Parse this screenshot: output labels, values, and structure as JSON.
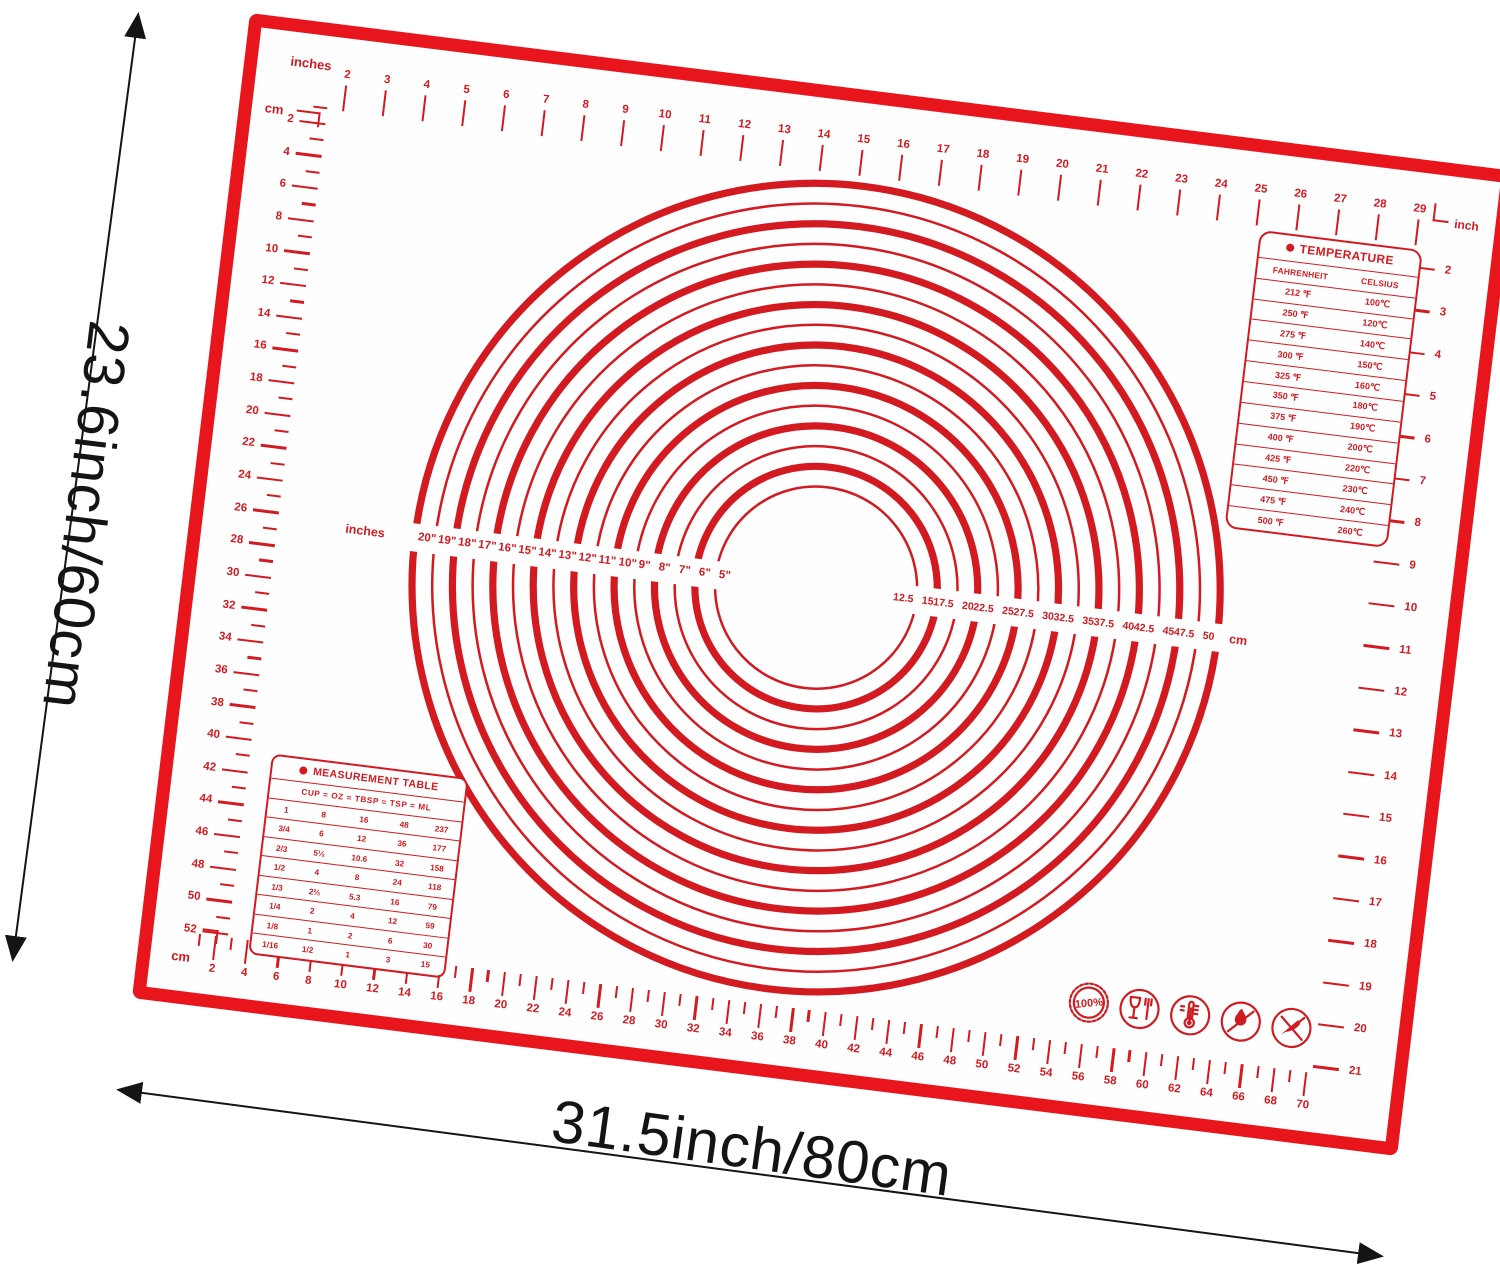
{
  "annotations": {
    "height_label": "23.6inch/60cm",
    "width_label": "31.5inch/80cm"
  },
  "colors": {
    "mat_frame_red": "#e8151d",
    "print_red": "#d31a21",
    "annotation_black": "#141414",
    "background": "#ffffff"
  },
  "rulers": {
    "top": {
      "unit_label": "inches",
      "numbers": [
        2,
        3,
        4,
        5,
        6,
        7,
        8,
        9,
        10,
        11,
        12,
        13,
        14,
        15,
        16,
        17,
        18,
        19,
        20,
        21,
        22,
        23,
        24,
        25,
        26,
        27,
        28,
        29
      ]
    },
    "right": {
      "unit_label": "inch",
      "numbers": [
        2,
        3,
        4,
        5,
        6,
        7,
        8,
        9,
        10,
        11,
        12,
        13,
        14,
        15,
        16,
        17,
        18,
        19,
        20,
        21
      ]
    },
    "left": {
      "unit_label": "cm",
      "numbers": [
        2,
        4,
        6,
        8,
        10,
        12,
        14,
        16,
        18,
        20,
        22,
        24,
        26,
        28,
        30,
        32,
        34,
        36,
        38,
        40,
        42,
        44,
        46,
        48,
        50,
        52
      ]
    },
    "bottom": {
      "unit_label": "cm",
      "numbers": [
        2,
        4,
        6,
        8,
        10,
        12,
        14,
        16,
        18,
        20,
        22,
        24,
        26,
        28,
        30,
        32,
        34,
        36,
        38,
        40,
        42,
        44,
        46,
        48,
        50,
        52,
        54,
        56,
        58,
        60,
        62,
        64,
        66,
        68,
        70
      ]
    }
  },
  "rolling_guide": {
    "inch_axis_label": "inches",
    "cm_axis_label": "cm",
    "diameters_inches": [
      5,
      6,
      7,
      8,
      9,
      10,
      11,
      12,
      13,
      14,
      15,
      16,
      17,
      18,
      19,
      20
    ],
    "inch_labels": [
      "20\"",
      "19\"",
      "18\"",
      "17\"",
      "16\"",
      "15\"",
      "14\"",
      "13\"",
      "12\"",
      "11\"",
      "10\"",
      "9\"",
      "8\"",
      "7\"",
      "6\"",
      "5\""
    ],
    "cm_labels": [
      "12.5",
      "15",
      "17.5",
      "20",
      "22.5",
      "25",
      "27.5",
      "30",
      "32.5",
      "35",
      "37.5",
      "40",
      "42.5",
      "45",
      "47.5",
      "50"
    ]
  },
  "temperature_table": {
    "title": "TEMPERATURE",
    "columns": [
      "FAHRENHEIT",
      "CELSIUS"
    ],
    "rows": [
      [
        "212 ℉",
        "100℃"
      ],
      [
        "250 ℉",
        "120℃"
      ],
      [
        "275 ℉",
        "140℃"
      ],
      [
        "300 ℉",
        "150℃"
      ],
      [
        "325 ℉",
        "160℃"
      ],
      [
        "350 ℉",
        "180℃"
      ],
      [
        "375 ℉",
        "190℃"
      ],
      [
        "400 ℉",
        "200℃"
      ],
      [
        "425 ℉",
        "220℃"
      ],
      [
        "450 ℉",
        "230℃"
      ],
      [
        "475 ℉",
        "240℃"
      ],
      [
        "500 ℉",
        "260℃"
      ]
    ]
  },
  "measurement_table": {
    "title": "MEASUREMENT TABLE",
    "header": "CUP  =  OZ  =  TBSP  =  TSP  =  ML",
    "rows": [
      [
        "1",
        "8",
        "16",
        "48",
        "237"
      ],
      [
        "3/4",
        "6",
        "12",
        "36",
        "177"
      ],
      [
        "2/3",
        "5⅓",
        "10.6",
        "32",
        "158"
      ],
      [
        "1/2",
        "4",
        "8",
        "24",
        "118"
      ],
      [
        "1/3",
        "2⅔",
        "5.3",
        "16",
        "79"
      ],
      [
        "1/4",
        "2",
        "4",
        "12",
        "59"
      ],
      [
        "1/8",
        "1",
        "2",
        "6",
        "30"
      ],
      [
        "1/16",
        "1/2",
        "1",
        "3",
        "15"
      ]
    ]
  },
  "icons": {
    "badge_text": "100%"
  }
}
